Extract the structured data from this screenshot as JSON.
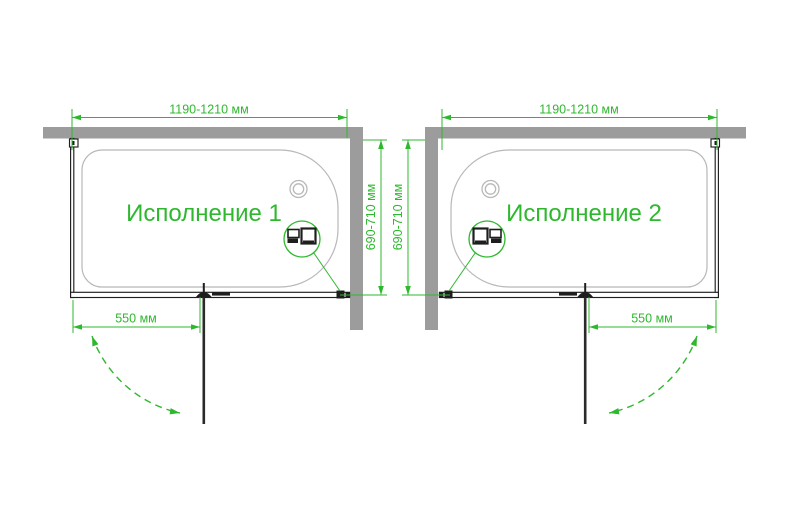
{
  "colors": {
    "green": "#2eb82e",
    "wall": "#9c9c9c",
    "tub": "#b8b8b8",
    "ink": "#1e1e1e",
    "bg": "#ffffff"
  },
  "diagrams": [
    {
      "title": "Исполнение 1",
      "width_dim": "1190-1210 мм",
      "depth_dim": "690-710 мм",
      "door_dim": "550 мм"
    },
    {
      "title": "Исполнение 2",
      "width_dim": "1190-1210 мм",
      "depth_dim": "690-710 мм",
      "door_dim": "550 мм"
    }
  ]
}
